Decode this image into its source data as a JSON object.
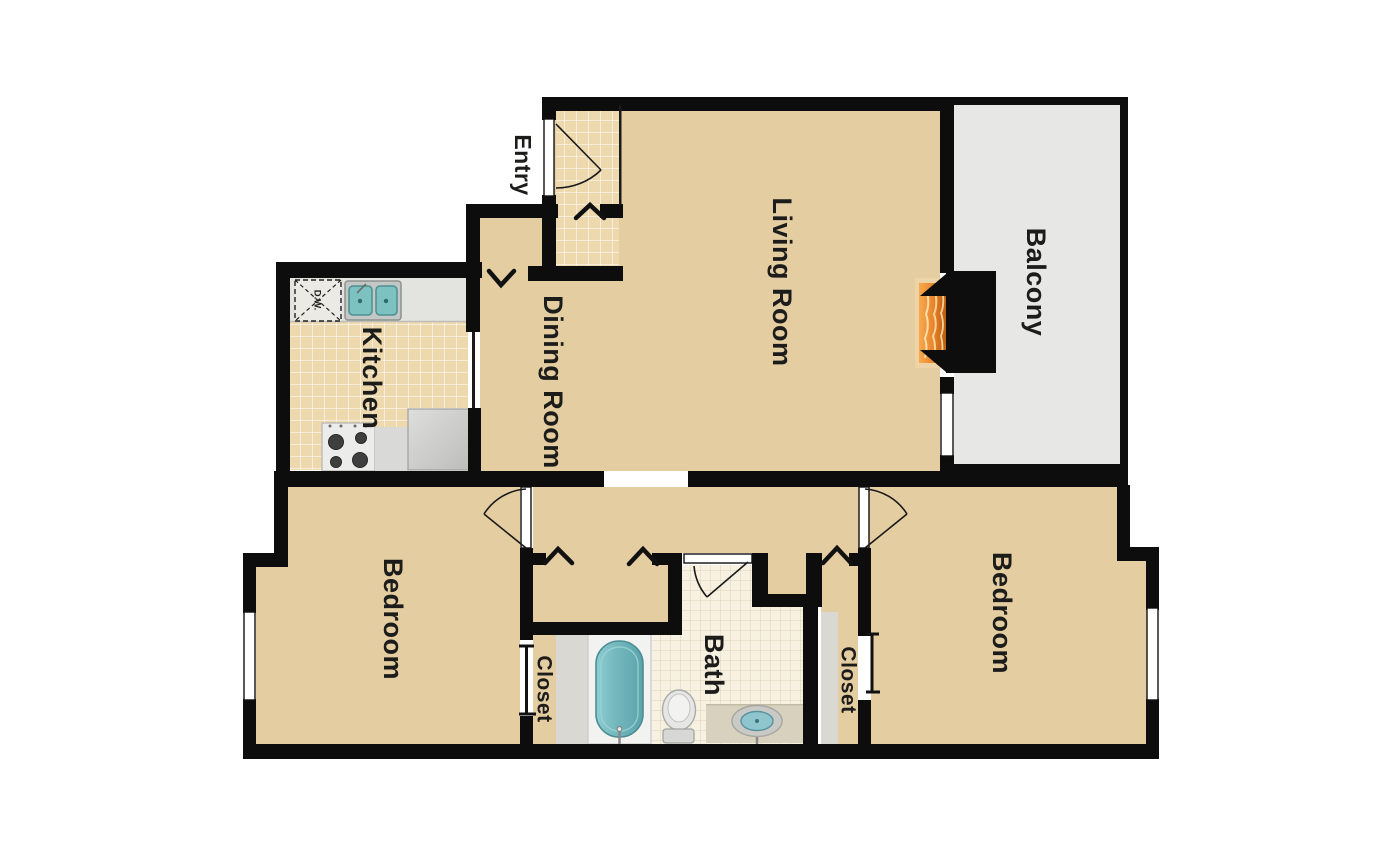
{
  "floor_plan": {
    "rooms": {
      "entry": {
        "label": "Entry"
      },
      "kitchen": {
        "label": "Kitchen"
      },
      "dining_room": {
        "label": "Dining Room"
      },
      "living_room": {
        "label": "Living Room"
      },
      "balcony": {
        "label": "Balcony"
      },
      "bedroom_left": {
        "label": "Bedroom"
      },
      "bedroom_right": {
        "label": "Bedroom"
      },
      "closet_left": {
        "label": "Closet"
      },
      "closet_right": {
        "label": "Closet"
      },
      "bath": {
        "label": "Bath"
      }
    },
    "fixtures": {
      "dishwasher_label": "D.W."
    },
    "colors": {
      "wall": "#0d0d0d",
      "carpet": "#e4cda0",
      "kitchen_tile": "#edd9ad",
      "bath_tile": "#f7f1e1",
      "balcony": "#e7e7e5",
      "counter": "#e3e3df",
      "teal": "#7cc2c1",
      "flame": "#e8862d"
    }
  }
}
